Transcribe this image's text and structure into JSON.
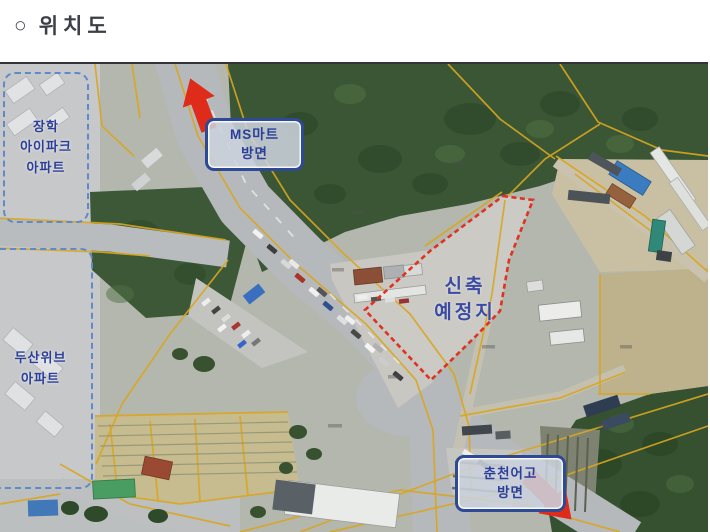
{
  "page": {
    "bullet": "○",
    "title": "위치도"
  },
  "map": {
    "labels": {
      "apt_janghak": {
        "line1": "장학",
        "line2": "아이파크",
        "line3": "아파트"
      },
      "apt_doosan": {
        "line1": "두산위브",
        "line2": "아파트"
      },
      "dir_msmart": {
        "line1": "MS마트",
        "line2": "방면"
      },
      "site": {
        "line1": "신축",
        "line2": "예정지"
      },
      "dir_chuncheon": {
        "line1": "춘천어고",
        "line2": "방면"
      }
    },
    "colors": {
      "forest": "#3a5634",
      "road": "#b6b9bc",
      "cadastral_line": "#d9a620",
      "site_outline": "#df3220",
      "arrow": "#de2b1a",
      "label_text": "#2b3e99",
      "direction_box_border": "#2e4a94",
      "apartment_box_border": "#6089cc"
    }
  }
}
